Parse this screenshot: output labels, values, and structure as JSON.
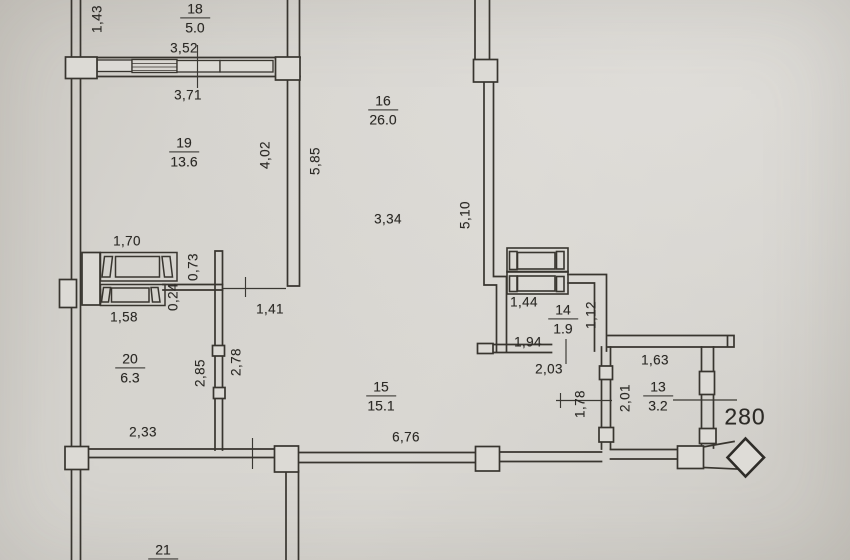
{
  "rooms": {
    "r18": {
      "number": "18",
      "area": "5.0"
    },
    "r19": {
      "number": "19",
      "area": "13.6"
    },
    "r16": {
      "number": "16",
      "area": "26.0"
    },
    "r20": {
      "number": "20",
      "area": "6.3"
    },
    "r15": {
      "number": "15",
      "area": "15.1"
    },
    "r14": {
      "number": "14",
      "area": "1.9"
    },
    "r13": {
      "number": "13",
      "area": "3.2"
    },
    "r21": {
      "number": "21",
      "area": ""
    }
  },
  "dims": {
    "v1_43": "1,43",
    "h3_52": "3,52",
    "h3_71": "3,71",
    "v4_02": "4,02",
    "v5_85": "5,85",
    "h3_34": "3,34",
    "v5_10": "5,10",
    "h1_70": "1,70",
    "v0_73": "0,73",
    "v0_24": "0,24",
    "h1_58": "1,58",
    "h1_41": "1,41",
    "v2_85": "2,85",
    "v2_78": "2,78",
    "h2_33": "2,33",
    "h6_76": "6,76",
    "h1_44": "1,44",
    "v1_12": "1,12",
    "h1_94": "1,94",
    "h2_03": "2,03",
    "h1_63": "1,63",
    "v2_01": "2,01",
    "v1_78": "1,78"
  },
  "marker": {
    "value": "280"
  }
}
